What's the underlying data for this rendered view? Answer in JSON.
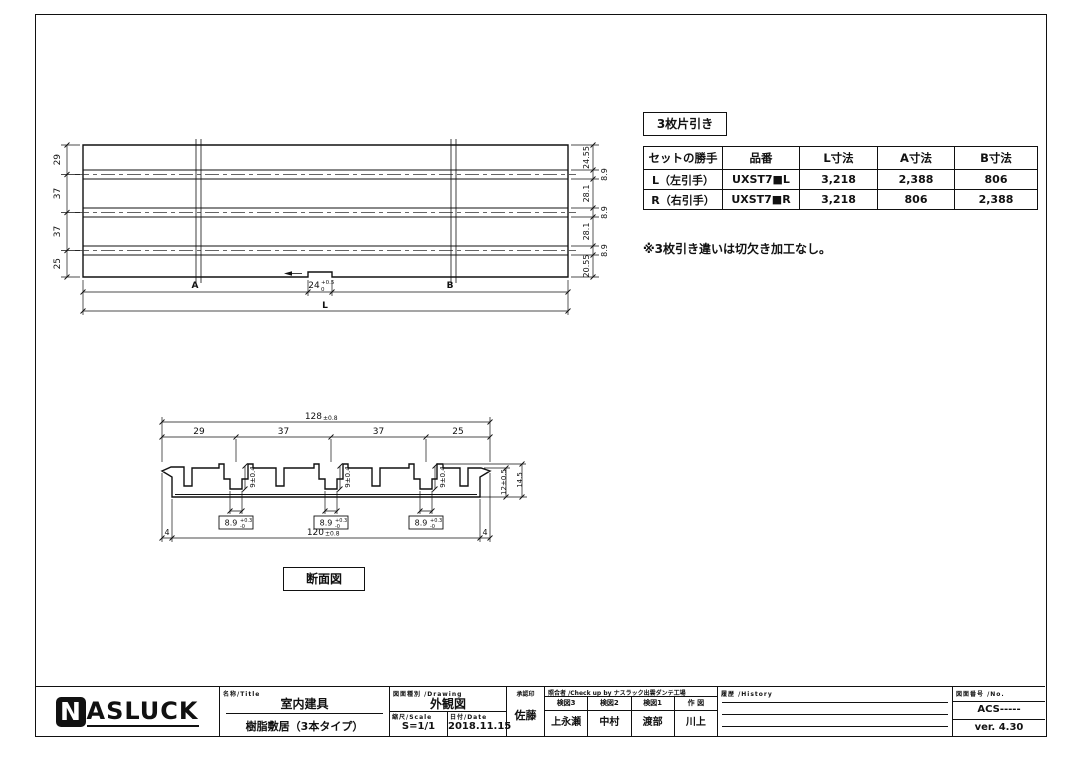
{
  "plan": {
    "left_dims": [
      "29",
      "37",
      "37",
      "25"
    ],
    "right_band_dims": [
      "24.55",
      "28.1",
      "28.1",
      "20.55"
    ],
    "right_rail_dims": [
      "8.9",
      "8.9",
      "8.9"
    ],
    "dim_a": "A",
    "dim_b": "B",
    "dim_l": "L",
    "notch_main": "24",
    "notch_sup": "+0.5",
    "notch_sub": "0"
  },
  "section": {
    "top_main": "128",
    "top_tol": "±0.8",
    "chain_dims": [
      "29",
      "37",
      "37",
      "25"
    ],
    "groove_depth": "9±0.4",
    "boxed_main": "8.9",
    "boxed_sup": "+0.3",
    "boxed_sub": "-0",
    "inner_height": "12±0.5",
    "total_height": "14.5",
    "bottom_main": "120",
    "bottom_tol": "±0.8",
    "edge_left": "4",
    "edge_right": "4",
    "label": "断面図"
  },
  "spec": {
    "title": "3枚片引き",
    "table": {
      "headers": [
        "セットの勝手",
        "品番",
        "L寸法",
        "A寸法",
        "B寸法"
      ],
      "rows": [
        [
          "L（左引手）",
          "UXST7■L",
          "3,218",
          "2,388",
          "806"
        ],
        [
          "R（右引手）",
          "UXST7■R",
          "3,218",
          "806",
          "2,388"
        ]
      ]
    },
    "note": "※3枚引き違いは切欠き加工なし。"
  },
  "title_block": {
    "logo_n": "N",
    "logo_rest": "ASLUCK",
    "name_label": "名称/Title",
    "name_top": "室内建具",
    "name_bottom": "樹脂敷居（3本タイプ）",
    "drawing_label": "図面種別 /Drawing",
    "drawing_value": "外観図",
    "scale_label": "縮尺/Scale",
    "scale_value": "S=1/1",
    "date_label": "日付/Date",
    "date_value": "2018.11.15",
    "approve_label": "承認印",
    "approve_value": "佐藤",
    "check_label": "照合者 /Check up by ナスラック出雲ダンテ工場",
    "check_headers": [
      "検図3",
      "検図2",
      "検図1",
      "作 図"
    ],
    "check_values": [
      "上永瀬",
      "中村",
      "渡部",
      "川上"
    ],
    "history_label": "履歴 /History",
    "no_label": "図面番号 /No.",
    "no_value": "ACS-----",
    "version": "ver. 4.30"
  }
}
